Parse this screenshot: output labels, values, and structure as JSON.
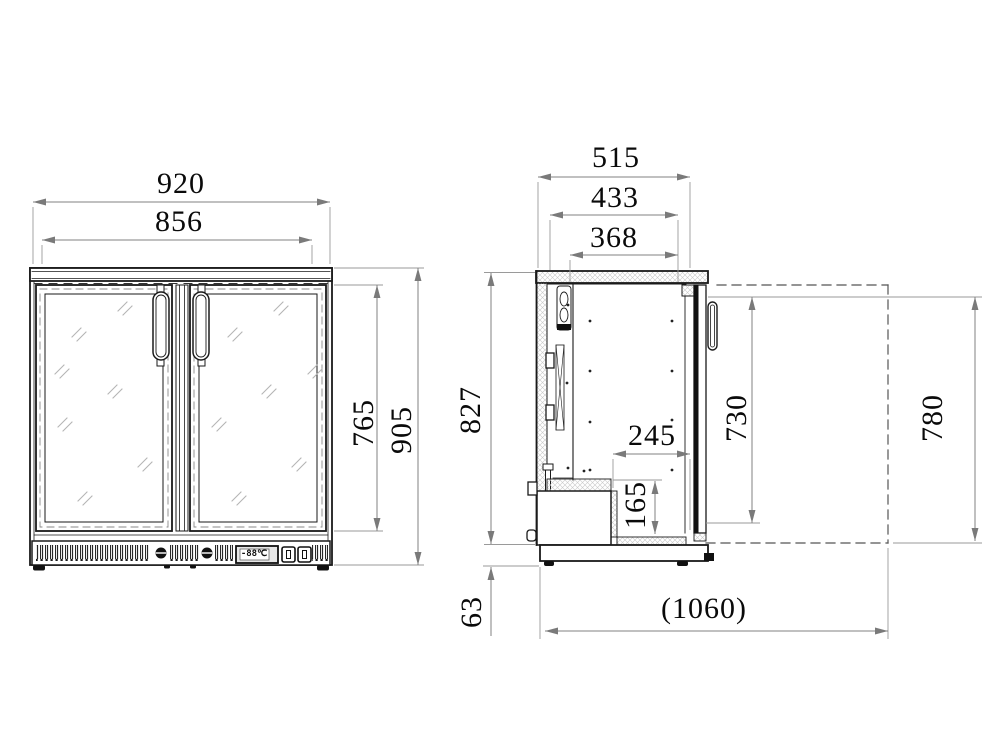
{
  "drawing": {
    "type": "technical-drawing",
    "views": [
      "front-elevation",
      "side-section"
    ],
    "colors": {
      "object_line": "#1a1a1a",
      "dimension_line": "#828282",
      "hatch": "#c9c9c9",
      "background": "#ffffff"
    }
  },
  "front_view": {
    "overall_width": "920",
    "door_width": "856",
    "door_height": "765",
    "overall_height": "905",
    "display_value": "-88℃"
  },
  "side_view": {
    "overall_depth": "515",
    "body_depth": "433",
    "interior_depth": "368",
    "worktop_height": "827",
    "recess_depth": "245",
    "recess_height": "165",
    "door_open_height_inner": "730",
    "door_open_height_outer": "780",
    "base_height": "63",
    "total_depth_door_open": "(1060)"
  }
}
